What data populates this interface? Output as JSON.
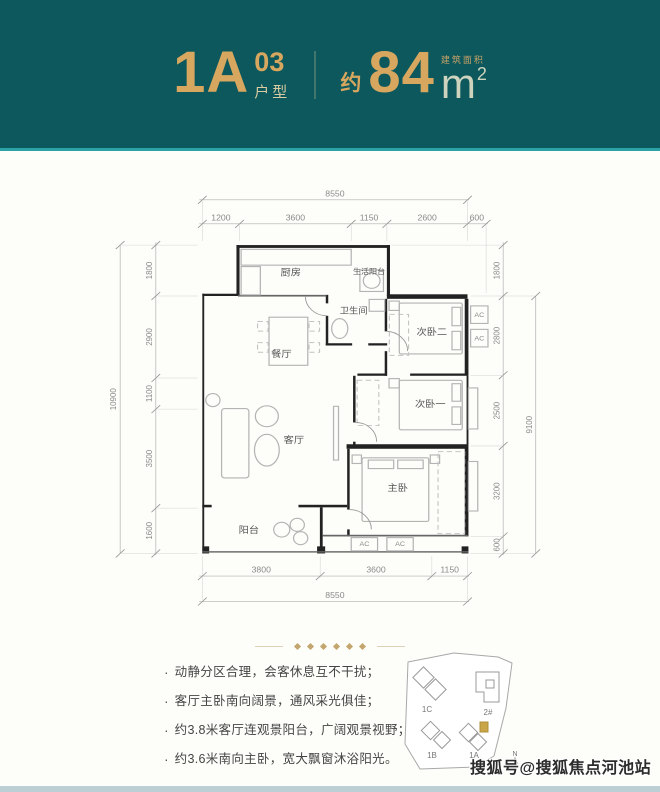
{
  "header": {
    "unit_main": "1A",
    "unit_sub": "03",
    "unit_label": "户型",
    "approx": "约",
    "area": "84",
    "area_unit": "m",
    "area_exp": "2",
    "area_caption": "建筑面积",
    "band_color": "#0c585c",
    "gold_color": "#d8a75f"
  },
  "plan": {
    "rooms": [
      "厨房",
      "生活阳台",
      "卫生间",
      "餐厅",
      "次卧二",
      "次卧一",
      "客厅",
      "主卧",
      "阳台"
    ],
    "ac": "AC",
    "dims": {
      "top_total": "8550",
      "top": [
        "1200",
        "3600",
        "1150",
        "2600",
        "600"
      ],
      "left_total": "10900",
      "left": [
        "1800",
        "2900",
        "1100",
        "3500",
        "1600"
      ],
      "right_total": "9100",
      "right": [
        "1800",
        "2800",
        "2500",
        "3200",
        "600"
      ],
      "bottom_total": "8550",
      "bottom": [
        "3800",
        "3600",
        "1150"
      ]
    }
  },
  "features": {
    "bullet": "·",
    "items": [
      "动静分区合理，会客休息互不干扰；",
      "客厅主卧南向阔景，通风采光俱佳；",
      "约3.8米客厅连观景阳台，广阔观景视野；",
      "约3.6米南向主卧，宽大飘窗沐浴阳光。"
    ]
  },
  "siteplan": {
    "buildings": [
      "1C",
      "2#",
      "1B",
      "1A"
    ],
    "north": "N"
  },
  "watermark": "搜狐号@搜狐焦点河池站"
}
